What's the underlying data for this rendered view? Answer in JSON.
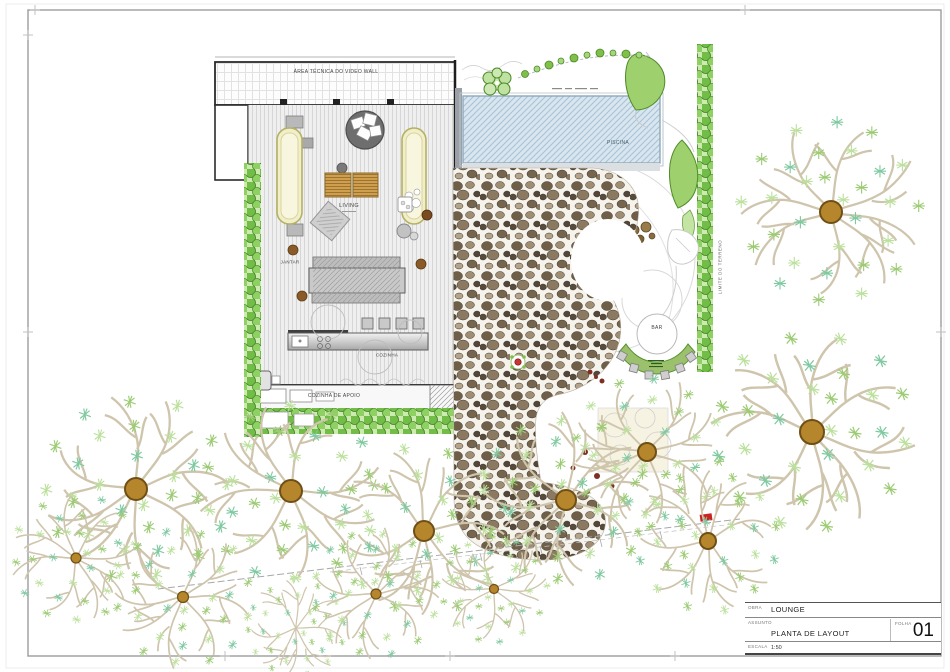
{
  "title_block": {
    "project_label": "OBRA",
    "project": "LOUNGE",
    "subject_label": "ASSUNTO",
    "subject": "PLANTA DE LAYOUT",
    "sheet_label": "FOLHA",
    "sheet_number": "01",
    "scale_label": "ESCALA",
    "scale": "1:50"
  },
  "plan_labels": {
    "area_tecnica": "ÁREA TÉCNICA DO VIDEO WALL",
    "living": "LIVING",
    "jantar": "JANTAR",
    "cozinha": "COZINHA",
    "cozinha_apoio": "COZINHA DE APOIO",
    "piscina": "PISCINA",
    "bar": "BAR",
    "limite_terreno": "LIMITE DO TERRENO"
  },
  "colors": {
    "hedge_green": "#72bd48",
    "canopy_green": "#9ccb74",
    "trunk_brown": "#b5862b",
    "pool_blue": "#d9e6ef",
    "stone_brown": "#7a6a52",
    "accent_red": "#cc2222"
  }
}
